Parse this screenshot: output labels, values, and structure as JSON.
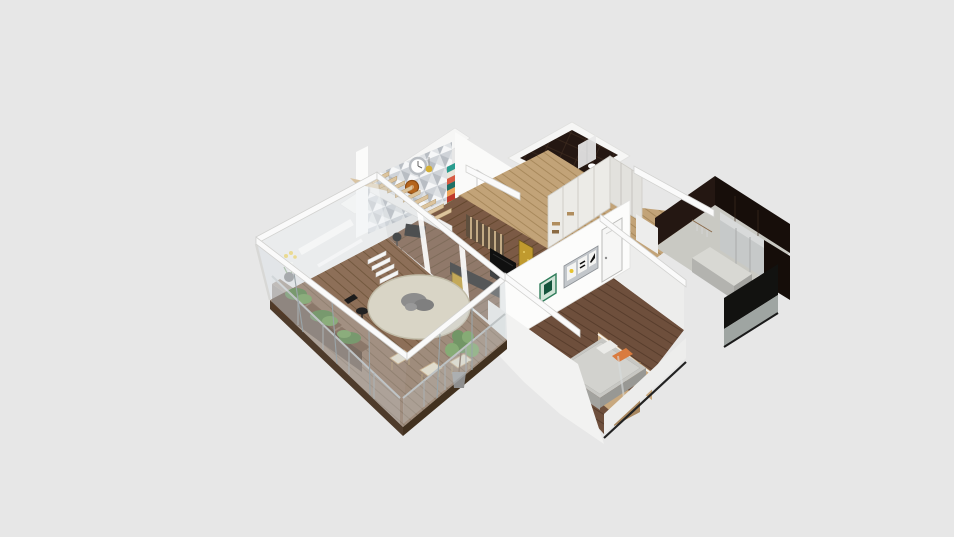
{
  "scene": {
    "label": "Isometric 3D floor plan rendering",
    "rooms": [
      "terrace",
      "living-room",
      "hallway",
      "bathroom",
      "kitchen",
      "bedroom"
    ]
  },
  "colors": {
    "background": "#e7e7e7",
    "wall-white": "#f6f6f5",
    "wall-shade": "#ededec",
    "beam-top": "#fafafa",
    "beam-edge": "#d2d2d0",
    "glass": "#cfd8dc",
    "glass-line": "#9aa4a8",
    "rail-metal": "#b7bbbc",
    "deck-wood": "#8d6f58",
    "deck-plank": "#73593f",
    "living-floor": "#7b5a45",
    "living-plank": "#64482f",
    "hall-floor": "#c2a378",
    "hall-plank": "#a8895c",
    "bedroom-floor": "#6e4f3c",
    "bedroom-plank": "#583d2c",
    "dark-tile": "#241712",
    "dark-tile2": "#170e0a",
    "tile-line": "#3d2a1f",
    "panel-oak": "#c8a87e",
    "panel-line": "#ad8a5c",
    "planter-wood": "#6a4c34",
    "planter-side": "#523a27",
    "plant-green": "#4e7d3a",
    "plant-green2": "#6a9a4e",
    "table-top": "#d9d5c6",
    "table-edge": "#c2bda9",
    "cushion": "#e6dfca",
    "chair-wood": "#c9a878",
    "tv-black": "#101010",
    "gold-art": "#c09a2e",
    "gold-frame": "#6f5a1c",
    "wardrobe-white": "#ecebe7",
    "wardrobe-line": "#cfcdc7",
    "cabinet-gray": "#c6c9c9",
    "counter-gray": "#d8d8d3",
    "bed-gray": "#c7c7c3",
    "bed-side": "#a3a39f",
    "pillow-orange": "#d97b3f",
    "accent-yellow": "#e6c32e",
    "shelf-stripe-1": "#2a9d8f",
    "shelf-stripe-2": "#e9e5da",
    "shelf-stripe-3": "#d95b43",
    "shelf-stripe-4": "#1f6f66",
    "shelf-stripe-5": "#eda45c",
    "shelf-stripe-6": "#c0392b",
    "shelf-stripe-7": "#7fae6a",
    "shelf-stripe-8": "#27434c",
    "clock-gray": "#b9bdc2",
    "clock-copper": "#b5651d"
  }
}
